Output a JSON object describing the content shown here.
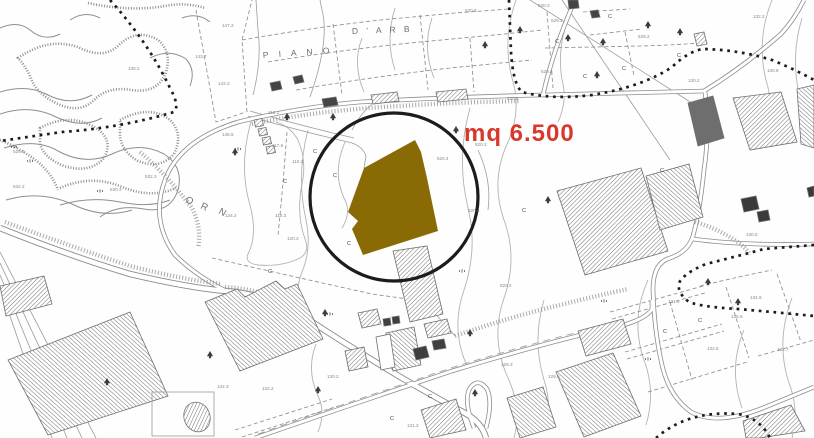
{
  "annotation": {
    "area_label": "mq 6.500",
    "color": "#d9382c"
  },
  "highlight": {
    "parcel_fill": "#8a6a05",
    "circle_stroke": "#1c1c1c"
  },
  "place_names": [
    {
      "text": "P I A N O",
      "x": 263,
      "y": 58,
      "rot": -4,
      "size": 8.5,
      "ls": 4
    },
    {
      "text": "D ' A R B",
      "x": 352,
      "y": 34,
      "rot": -2,
      "size": 8.5,
      "ls": 3
    },
    {
      "text": "O",
      "x": 185,
      "y": 202,
      "rot": 22,
      "size": 9.5,
      "ls": 0
    },
    {
      "text": "R",
      "x": 200,
      "y": 208,
      "rot": 26,
      "size": 9.5,
      "ls": 0
    },
    {
      "text": "N",
      "x": 218,
      "y": 213,
      "rot": 30,
      "size": 9.5,
      "ls": 0
    }
  ],
  "elevation_labels": [
    {
      "t": "529.2",
      "x": 551,
      "y": 22
    },
    {
      "t": "529.2",
      "x": 541,
      "y": 73
    },
    {
      "t": "520.3",
      "x": 538,
      "y": 7
    },
    {
      "t": "520.8",
      "x": 465,
      "y": 12
    },
    {
      "t": "520.8",
      "x": 507,
      "y": 100
    },
    {
      "t": "529.2",
      "x": 638,
      "y": 38
    },
    {
      "t": "132.2",
      "x": 753,
      "y": 18
    },
    {
      "t": "130.8",
      "x": 767,
      "y": 72
    },
    {
      "t": "130.2",
      "x": 688,
      "y": 82
    },
    {
      "t": "520.2",
      "x": 475,
      "y": 146
    },
    {
      "t": "520.4",
      "x": 437,
      "y": 160
    },
    {
      "t": "520.4",
      "x": 468,
      "y": 212
    },
    {
      "t": "520.2",
      "x": 500,
      "y": 287
    },
    {
      "t": "117.6",
      "x": 272,
      "y": 147
    },
    {
      "t": "118.2",
      "x": 268,
      "y": 114
    },
    {
      "t": "110.2",
      "x": 292,
      "y": 163
    },
    {
      "t": "110.3",
      "x": 275,
      "y": 217
    },
    {
      "t": "120.3",
      "x": 287,
      "y": 240
    },
    {
      "t": "134.2",
      "x": 225,
      "y": 217
    },
    {
      "t": "532.3",
      "x": 145,
      "y": 178
    },
    {
      "t": "530.3",
      "x": 110,
      "y": 191
    },
    {
      "t": "532.2",
      "x": 13,
      "y": 188
    },
    {
      "t": "528.3",
      "x": 13,
      "y": 153
    },
    {
      "t": "135.2",
      "x": 128,
      "y": 70
    },
    {
      "t": "143.7",
      "x": 195,
      "y": 58
    },
    {
      "t": "147.2",
      "x": 222,
      "y": 27
    },
    {
      "t": "142.2",
      "x": 218,
      "y": 85
    },
    {
      "t": "145.5",
      "x": 222,
      "y": 136
    },
    {
      "t": "131.5",
      "x": 668,
      "y": 303
    },
    {
      "t": "134.6",
      "x": 750,
      "y": 299
    },
    {
      "t": "135.6",
      "x": 731,
      "y": 318
    },
    {
      "t": "132.6",
      "x": 707,
      "y": 350
    },
    {
      "t": "132.7",
      "x": 777,
      "y": 351
    },
    {
      "t": "130.6",
      "x": 746,
      "y": 236
    },
    {
      "t": "129.3",
      "x": 501,
      "y": 366
    },
    {
      "t": "129.6",
      "x": 548,
      "y": 378
    },
    {
      "t": "130.2",
      "x": 327,
      "y": 378
    },
    {
      "t": "132.2",
      "x": 262,
      "y": 390
    },
    {
      "t": "131.2",
      "x": 407,
      "y": 427
    },
    {
      "t": "132.3",
      "x": 217,
      "y": 388
    }
  ],
  "crop_marks": {
    "glyph": "C",
    "positions": [
      [
        313,
        153
      ],
      [
        333,
        177
      ],
      [
        283,
        183
      ],
      [
        347,
        245
      ],
      [
        555,
        43
      ],
      [
        583,
        78
      ],
      [
        622,
        70
      ],
      [
        677,
        57
      ],
      [
        522,
        212
      ],
      [
        660,
        172
      ],
      [
        698,
        322
      ],
      [
        663,
        333
      ],
      [
        390,
        420
      ],
      [
        428,
        398
      ],
      [
        268,
        273
      ],
      [
        608,
        18
      ]
    ]
  },
  "symbols": {
    "conifer_trees": [
      [
        287,
        117
      ],
      [
        333,
        117
      ],
      [
        235,
        152
      ],
      [
        485,
        45
      ],
      [
        520,
        30
      ],
      [
        568,
        38
      ],
      [
        603,
        42
      ],
      [
        648,
        25
      ],
      [
        680,
        32
      ],
      [
        597,
        75
      ],
      [
        548,
        200
      ],
      [
        456,
        130
      ],
      [
        470,
        333
      ],
      [
        708,
        282
      ],
      [
        738,
        302
      ],
      [
        325,
        313
      ],
      [
        210,
        355
      ],
      [
        107,
        382
      ],
      [
        318,
        390
      ],
      [
        475,
        393
      ]
    ],
    "marsh_tufts": [
      [
        14,
        148
      ],
      [
        30,
        162
      ],
      [
        100,
        192
      ],
      [
        238,
        150
      ],
      [
        462,
        272
      ],
      [
        604,
        302
      ],
      [
        648,
        360
      ],
      [
        330,
        315
      ]
    ]
  }
}
